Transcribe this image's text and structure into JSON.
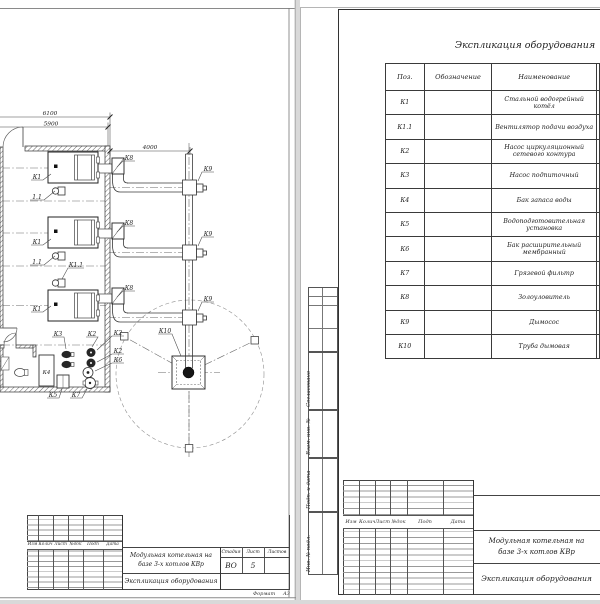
{
  "plan": {
    "dims": {
      "w_outer": "6100",
      "w_inner": "5900",
      "duct_span": "4000"
    },
    "labels": {
      "k1": "К1",
      "fan": "1.1",
      "k1_1": "К1.1",
      "k2": "К2",
      "k3": "К3",
      "k4": "К4",
      "k5": "К5",
      "k6": "К6",
      "k7": "К7",
      "k8": "К8",
      "k9": "К9",
      "k10": "К10"
    }
  },
  "equip_table": {
    "title": "Экспликация оборудования",
    "columns": [
      "Поз.",
      "Обозначение",
      "Наименование"
    ],
    "rows": [
      {
        "pos": "К1",
        "name": "Стальной водогрейный котёл"
      },
      {
        "pos": "К1.1",
        "name": "Вентилятор подачи воздуха"
      },
      {
        "pos": "К2",
        "name": "Насос циркуляционный сетевого контура"
      },
      {
        "pos": "К3",
        "name": "Насос подпиточный"
      },
      {
        "pos": "К4",
        "name": "Бак запаса воды"
      },
      {
        "pos": "К5",
        "name": "Водоподготовительная установка"
      },
      {
        "pos": "К6",
        "name": "Бак расширительный мембранный"
      },
      {
        "pos": "К7",
        "name": "Грязевой фильтр"
      },
      {
        "pos": "К8",
        "name": "Золоуловитель"
      },
      {
        "pos": "К9",
        "name": "Дымосос"
      },
      {
        "pos": "К10",
        "name": "Труба дымовая"
      }
    ]
  },
  "stamp": {
    "rev_cols": [
      "Изм",
      "Колич",
      "Лист",
      "№док",
      "Подп",
      "Дата"
    ],
    "project_title_1": "Модульная котельная на",
    "project_title_2": "базе 3-х котлов КВр",
    "doc_title": "Экспликация оборудования",
    "stage_label": "Стадия",
    "sheet_label": "Лист",
    "sheets_label": "Листов",
    "stage": "ВО",
    "sheet_num": "5",
    "format_label": "Формат",
    "format_value": "А3"
  },
  "margin_stamps": [
    "Согласовано",
    "Взам. инв. №",
    "Подп. и дата",
    "Инв. № подл."
  ]
}
